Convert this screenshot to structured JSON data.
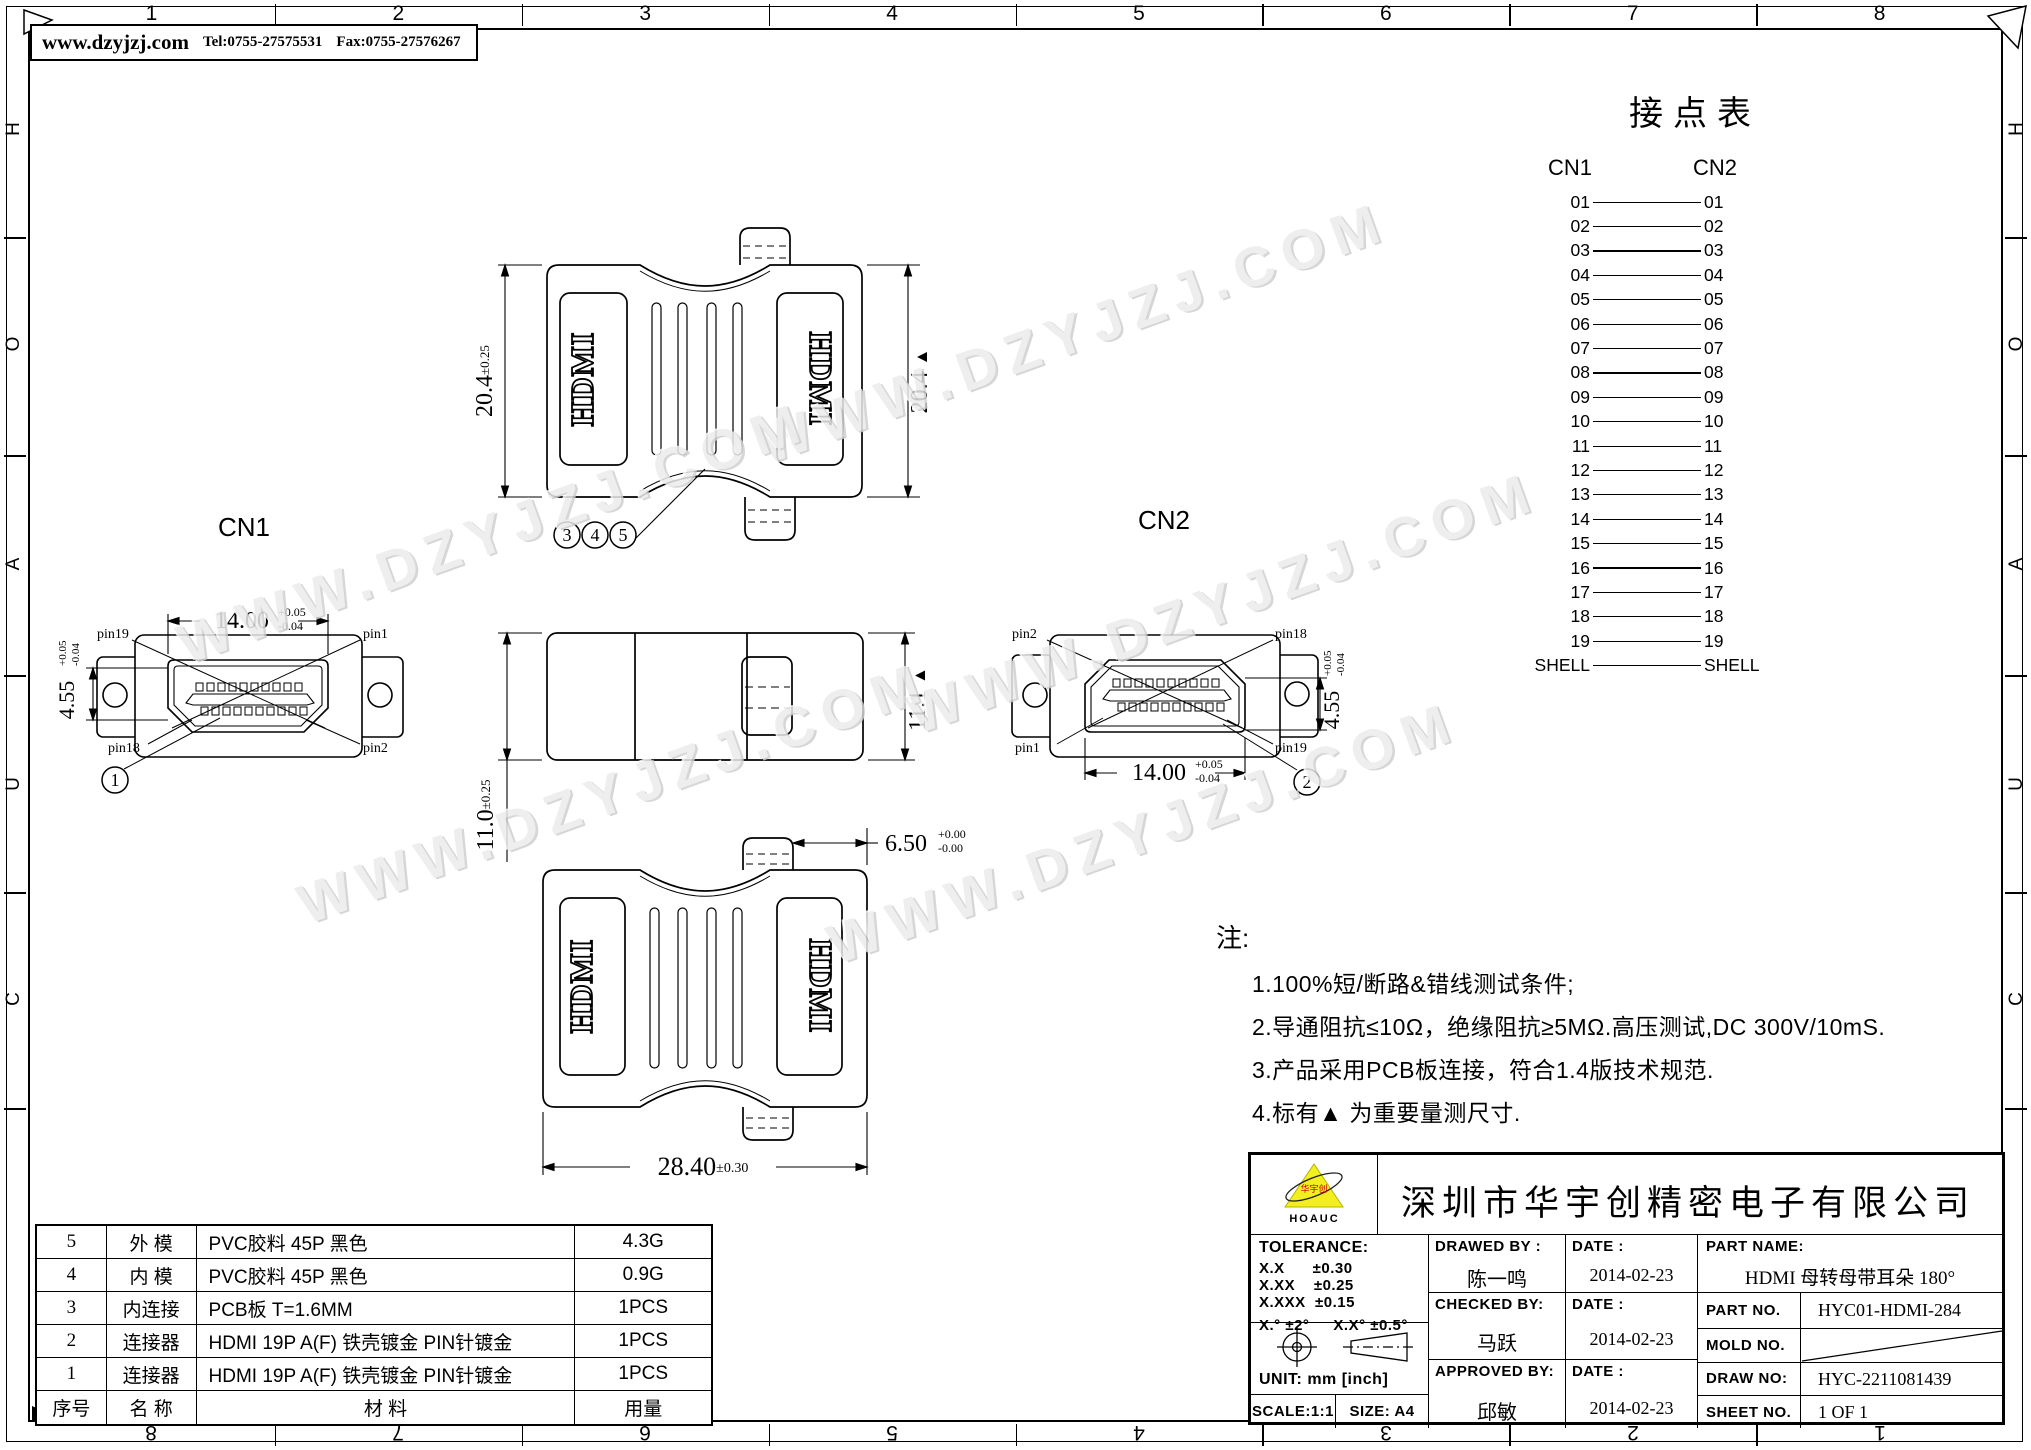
{
  "contact_header": {
    "website": "www.dzyjzj.com",
    "tel": "Tel:0755-27575531",
    "fax": "Fax:0755-27576267"
  },
  "frame": {
    "top_numbers": [
      "1",
      "2",
      "3",
      "4",
      "5",
      "6",
      "7",
      "8"
    ],
    "bottom_numbers": [
      "8",
      "7",
      "6",
      "5",
      "4",
      "3",
      "2",
      "1"
    ],
    "side_letters": [
      "H",
      "O",
      "A",
      "U",
      "C"
    ]
  },
  "watermark": {
    "text": "WWW.DZYJZJ.COM"
  },
  "junction_table": {
    "title": "接点表",
    "left_header": "CN1",
    "right_header": "CN2",
    "pins": [
      "01",
      "02",
      "03",
      "04",
      "05",
      "06",
      "07",
      "08",
      "09",
      "10",
      "11",
      "12",
      "13",
      "14",
      "15",
      "16",
      "17",
      "18",
      "19",
      "SHELL"
    ]
  },
  "labels": {
    "cn1": "CN1",
    "cn2": "CN2",
    "hdmi": "HDMI"
  },
  "pin_labels": {
    "p1": "pin1",
    "p2": "pin2",
    "p18": "pin18",
    "p19": "pin19"
  },
  "callouts": {
    "c1": "1",
    "c2": "2",
    "c3": "3",
    "c4": "4",
    "c5": "5"
  },
  "dimensions": {
    "top_height": {
      "value": "20.4",
      "tol": "±0.25"
    },
    "top_height_ref": {
      "value": "20.4",
      "mark": "▲"
    },
    "cn_width": {
      "value": "14.00",
      "tol_up": "+0.05",
      "tol_dn": "-0.04"
    },
    "cn_height": {
      "value": "4.55",
      "tol_up": "+0.05",
      "tol_dn": "-0.04"
    },
    "side_height": {
      "value": "11.0",
      "tol": "±0.25"
    },
    "side_height_ref": {
      "value": "11.1",
      "mark": "▲"
    },
    "tab_offset": {
      "value": "6.50",
      "tol_up": "+0.00",
      "tol_dn": "-0.00"
    },
    "body_width": {
      "value": "28.40",
      "tol": "±0.30"
    }
  },
  "notes": {
    "title": "注:",
    "items": [
      "1.100%短/断路&错线测试条件;",
      "2.导通阻抗≤10Ω，绝缘阻抗≥5MΩ.高压测试,DC 300V/10mS.",
      "3.产品采用PCB板连接，符合1.4版技术规范.",
      "4.标有▲ 为重要量测尺寸."
    ]
  },
  "bom": {
    "rows": [
      {
        "no": "5",
        "name": "外 模",
        "material": "PVC胶料 45P 黑色",
        "qty": "4.3G"
      },
      {
        "no": "4",
        "name": "内 模",
        "material": "PVC胶料 45P 黑色",
        "qty": "0.9G"
      },
      {
        "no": "3",
        "name": "内连接",
        "material": "PCB板 T=1.6MM",
        "qty": "1PCS"
      },
      {
        "no": "2",
        "name": "连接器",
        "material": "HDMI 19P A(F) 铁壳镀金 PIN针镀金",
        "qty": "1PCS"
      },
      {
        "no": "1",
        "name": "连接器",
        "material": "HDMI 19P A(F) 铁壳镀金 PIN针镀金",
        "qty": "1PCS"
      }
    ],
    "header": {
      "no": "序号",
      "name": "名 称",
      "material": "材 料",
      "qty": "用量"
    }
  },
  "title_block": {
    "company": "深圳市华宇创精密电子有限公司",
    "logo_text": "华宇创",
    "logo_sub": "HOAUC",
    "logo_color": "#f3ee1e",
    "tolerance": {
      "label": "TOLERANCE:",
      "lines": [
        "X.X      ±0.30",
        "X.XX    ±0.25",
        "X.XXX  ±0.15"
      ],
      "angles_a": "X.°  ±2°",
      "angles_b": "X.X°  ±0.5°"
    },
    "unit": "UNIT:  mm  [inch]",
    "scale": "SCALE:1:1",
    "size": "SIZE:  A4",
    "drawed_by": {
      "label": "DRAWED  BY :",
      "name": "陈一鸣"
    },
    "checked_by": {
      "label": "CHECKED  BY:",
      "name": "马跃"
    },
    "approved_by": {
      "label": "APPROVED  BY:",
      "name": "邱敏"
    },
    "date_label": "DATE :",
    "dates": [
      "2014-02-23",
      "2014-02-23",
      "2014-02-23"
    ],
    "part_name": {
      "label": "PART  NAME:",
      "value": "HDMI  母转母带耳朵  180°"
    },
    "part_no": {
      "label": "PART  NO.",
      "value": "HYC01-HDMI-284"
    },
    "mold_no": {
      "label": "MOLD  NO.",
      "value": ""
    },
    "draw_no": {
      "label": "DRAW  NO:",
      "value": "HYC-2211081439"
    },
    "sheet_no": {
      "label": "SHEET  NO.",
      "value": "1 OF 1"
    }
  }
}
